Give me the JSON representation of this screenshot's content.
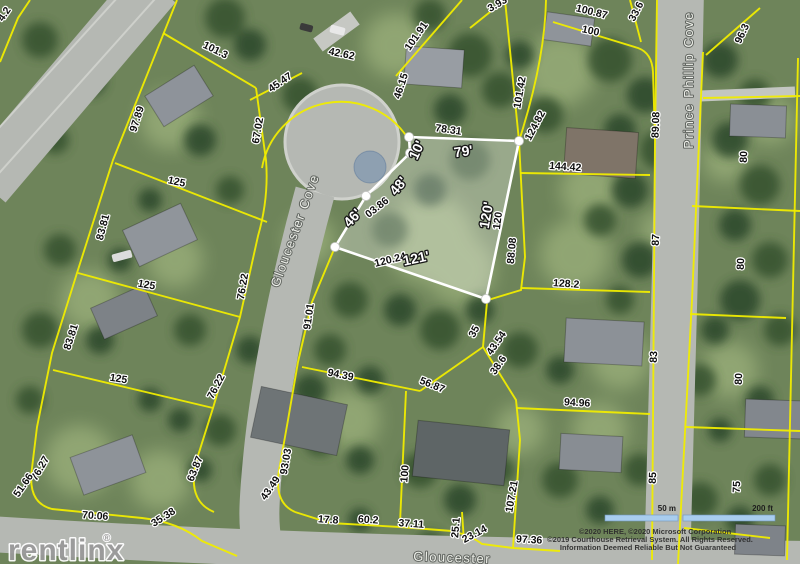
{
  "watermark": {
    "brand": "rentlinx",
    "registered": "®"
  },
  "streets": [
    {
      "text": "Gloucester Cove",
      "x": 299,
      "y": 232,
      "rot": -70,
      "size": 13
    },
    {
      "text": "Prince Phillip Cove",
      "x": 693,
      "y": 80,
      "rot": -90,
      "size": 14
    },
    {
      "text": "Gloucester",
      "x": 452,
      "y": 562,
      "rot": 2,
      "size": 13
    }
  ],
  "scale_bar": {
    "metric": "50 m",
    "imperial": "200 ft"
  },
  "copyright_lines": [
    "©2020 HERE, ©2020 Microsoft Corporation",
    "©2019 Courthouse Retrieval System. All Rights Reserved.",
    "Information Deemed Reliable But Not Guaranteed"
  ],
  "highlighted_parcel_labels": [
    {
      "text": "10'",
      "x": 421,
      "y": 152,
      "rot": -65,
      "size": 13
    },
    {
      "text": "79'",
      "x": 464,
      "y": 156,
      "rot": -8,
      "size": 14
    },
    {
      "text": "48'",
      "x": 402,
      "y": 189,
      "rot": -50,
      "size": 13
    },
    {
      "text": "46'",
      "x": 356,
      "y": 221,
      "rot": -48,
      "size": 14
    },
    {
      "text": "120'",
      "x": 491,
      "y": 216,
      "rot": -80,
      "size": 14
    },
    {
      "text": "121'",
      "x": 417,
      "y": 263,
      "rot": -12,
      "size": 16
    }
  ],
  "dimension_labels": [
    {
      "text": "4.2",
      "x": 7,
      "y": 16,
      "rot": -55
    },
    {
      "text": "101.3",
      "x": 214,
      "y": 53,
      "rot": 26
    },
    {
      "text": "97.89",
      "x": 140,
      "y": 120,
      "rot": -72
    },
    {
      "text": "67.02",
      "x": 261,
      "y": 131,
      "rot": -80
    },
    {
      "text": "45.47",
      "x": 282,
      "y": 85,
      "rot": -35
    },
    {
      "text": "42.62",
      "x": 341,
      "y": 57,
      "rot": 12
    },
    {
      "text": "101.91",
      "x": 419,
      "y": 38,
      "rot": -55
    },
    {
      "text": "46.15",
      "x": 404,
      "y": 87,
      "rot": -72
    },
    {
      "text": "3.93",
      "x": 499,
      "y": 7,
      "rot": -30
    },
    {
      "text": "100.87",
      "x": 591,
      "y": 15,
      "rot": 14
    },
    {
      "text": "100",
      "x": 590,
      "y": 34,
      "rot": 12
    },
    {
      "text": "33.6",
      "x": 639,
      "y": 13,
      "rot": -62
    },
    {
      "text": "96.3",
      "x": 745,
      "y": 35,
      "rot": -65
    },
    {
      "text": "101.42",
      "x": 523,
      "y": 93,
      "rot": -80
    },
    {
      "text": "124.82",
      "x": 538,
      "y": 127,
      "rot": -62
    },
    {
      "text": "89.08",
      "x": 659,
      "y": 125,
      "rot": -88
    },
    {
      "text": "78.31",
      "x": 448,
      "y": 133,
      "rot": 8
    },
    {
      "text": "03.86",
      "x": 379,
      "y": 210,
      "rot": -38
    },
    {
      "text": "120",
      "x": 501,
      "y": 221,
      "rot": -83
    },
    {
      "text": "88.08",
      "x": 515,
      "y": 251,
      "rot": -85
    },
    {
      "text": "120.24",
      "x": 391,
      "y": 263,
      "rot": -14
    },
    {
      "text": "144.42",
      "x": 565,
      "y": 170,
      "rot": 4
    },
    {
      "text": "128.2",
      "x": 566,
      "y": 287,
      "rot": 4
    },
    {
      "text": "87",
      "x": 659,
      "y": 240,
      "rot": -88
    },
    {
      "text": "80",
      "x": 747,
      "y": 157,
      "rot": -88
    },
    {
      "text": "80",
      "x": 744,
      "y": 264,
      "rot": -88
    },
    {
      "text": "80",
      "x": 742,
      "y": 379,
      "rot": -88
    },
    {
      "text": "75",
      "x": 740,
      "y": 487,
      "rot": -88
    },
    {
      "text": "83",
      "x": 657,
      "y": 357,
      "rot": -88
    },
    {
      "text": "85",
      "x": 656,
      "y": 478,
      "rot": -88
    },
    {
      "text": "94.96",
      "x": 577,
      "y": 406,
      "rot": 3
    },
    {
      "text": "76.22",
      "x": 246,
      "y": 287,
      "rot": -80
    },
    {
      "text": "125",
      "x": 176,
      "y": 185,
      "rot": 12
    },
    {
      "text": "83.81",
      "x": 106,
      "y": 228,
      "rot": -75
    },
    {
      "text": "125",
      "x": 146,
      "y": 288,
      "rot": 10
    },
    {
      "text": "83.81",
      "x": 74,
      "y": 338,
      "rot": -72
    },
    {
      "text": "125",
      "x": 118,
      "y": 382,
      "rot": 9
    },
    {
      "text": "76.22",
      "x": 219,
      "y": 388,
      "rot": -62
    },
    {
      "text": "63.87",
      "x": 198,
      "y": 470,
      "rot": -68
    },
    {
      "text": "76.27",
      "x": 43,
      "y": 470,
      "rot": -60
    },
    {
      "text": "51.66",
      "x": 26,
      "y": 487,
      "rot": -55
    },
    {
      "text": "70.06",
      "x": 95,
      "y": 519,
      "rot": 4
    },
    {
      "text": "35.38",
      "x": 165,
      "y": 520,
      "rot": -32
    },
    {
      "text": "91.01",
      "x": 312,
      "y": 317,
      "rot": -82
    },
    {
      "text": "94.39",
      "x": 340,
      "y": 378,
      "rot": 11
    },
    {
      "text": "56.87",
      "x": 431,
      "y": 388,
      "rot": 22
    },
    {
      "text": "93.03",
      "x": 289,
      "y": 462,
      "rot": -80
    },
    {
      "text": "43.49",
      "x": 273,
      "y": 490,
      "rot": -55
    },
    {
      "text": "17.8",
      "x": 328,
      "y": 523,
      "rot": 4
    },
    {
      "text": "60.2",
      "x": 368,
      "y": 523,
      "rot": 4
    },
    {
      "text": "37.11",
      "x": 411,
      "y": 527,
      "rot": 4
    },
    {
      "text": "25.1",
      "x": 459,
      "y": 528,
      "rot": -85
    },
    {
      "text": "23.14",
      "x": 476,
      "y": 537,
      "rot": -28
    },
    {
      "text": "97.36",
      "x": 529,
      "y": 543,
      "rot": 3
    },
    {
      "text": "100",
      "x": 408,
      "y": 474,
      "rot": -85
    },
    {
      "text": "107.21",
      "x": 515,
      "y": 497,
      "rot": -80
    },
    {
      "text": "35",
      "x": 477,
      "y": 333,
      "rot": -62
    },
    {
      "text": "43.54",
      "x": 499,
      "y": 345,
      "rot": -55
    },
    {
      "text": "38.6",
      "x": 501,
      "y": 367,
      "rot": -55
    }
  ]
}
